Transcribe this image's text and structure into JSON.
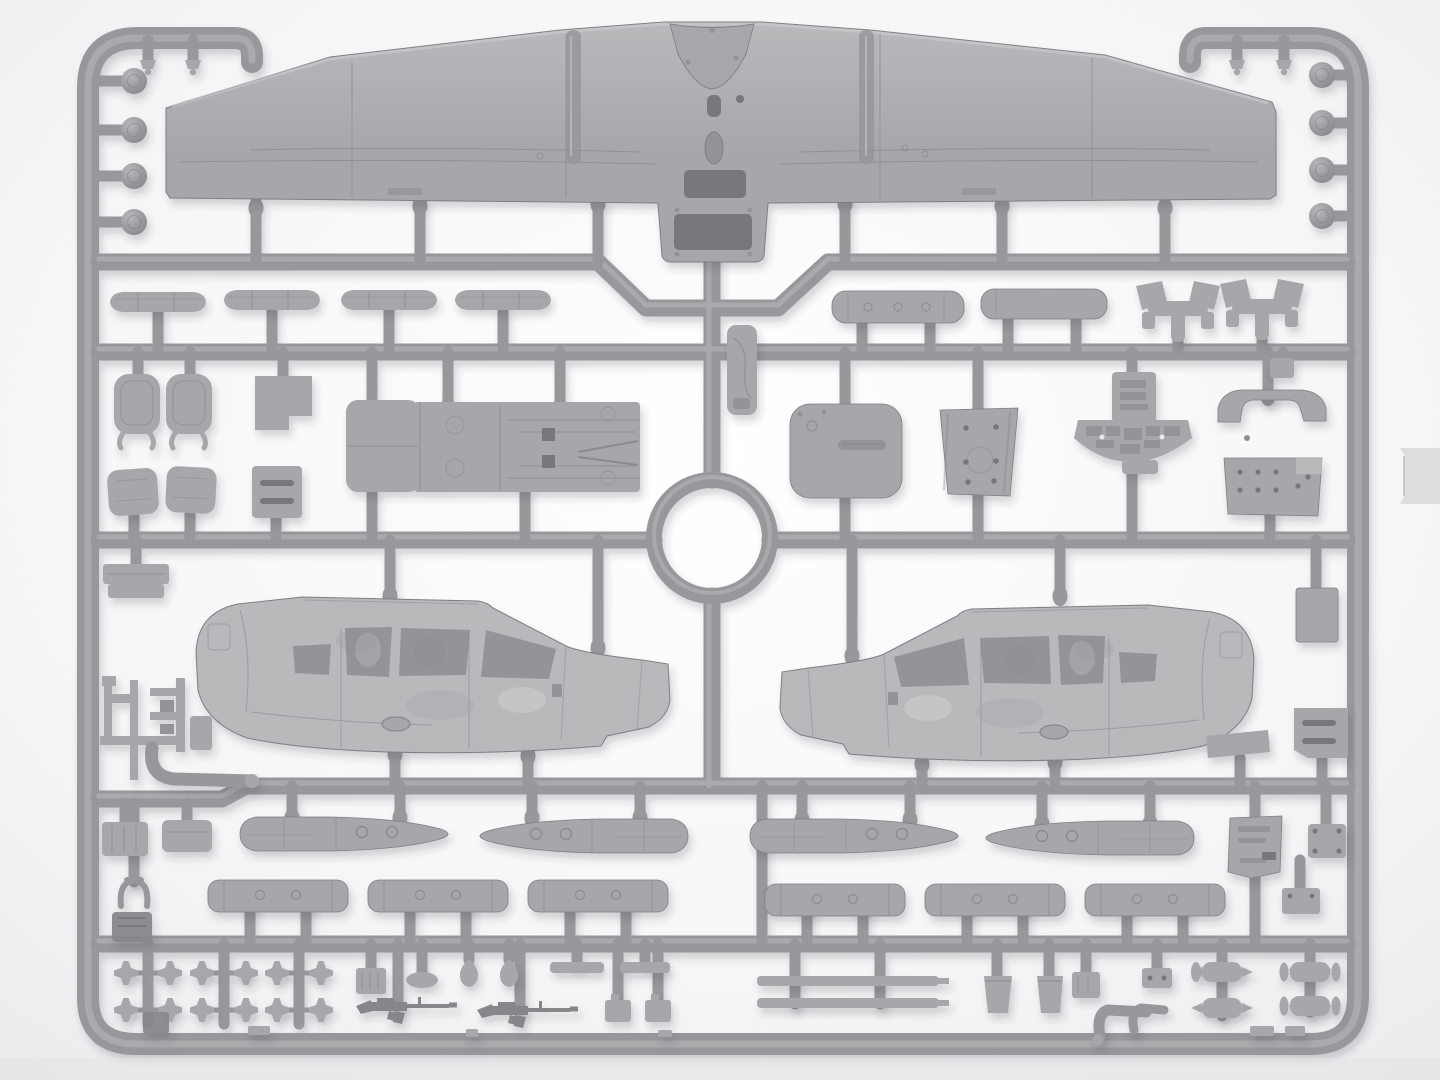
{
  "image_type": "photograph",
  "subject": {
    "description": "Gray injection-moulded plastic model-kit sprue of a twin-boom observation aircraft (one-piece wing, two fuselage pod halves, drop tanks, rocket pods, cockpit interior parts and small weapons) photographed on a white background",
    "orientation": "landscape",
    "material": "light-gray styrene plastic",
    "parts_visible": [
      {
        "name": "one-piece wing with cabin roof section",
        "count": 1
      },
      {
        "name": "fuselage pod half",
        "count": 2
      },
      {
        "name": "drop-tank half",
        "count": 4
      },
      {
        "name": "rocket-pod tube half",
        "count": 6
      },
      {
        "name": "slender pod / float blade",
        "count": 4
      },
      {
        "name": "engine cylinder drum",
        "count": 2
      },
      {
        "name": "engine mount bracket",
        "count": 2
      },
      {
        "name": "seat back",
        "count": 2
      },
      {
        "name": "seat cushion",
        "count": 2
      },
      {
        "name": "cabin floor",
        "count": 1
      },
      {
        "name": "cabin door panel",
        "count": 1
      },
      {
        "name": "riveted access panel",
        "count": 2
      },
      {
        "name": "instrument panel with radio console",
        "count": 1
      },
      {
        "name": "glareshield coaming",
        "count": 1
      },
      {
        "name": "slotted bulkhead panel",
        "count": 3
      },
      {
        "name": "engine-mount lattice frame",
        "count": 2
      },
      {
        "name": "exhaust elbow pipe",
        "count": 3
      },
      {
        "name": "M16 rifle",
        "count": 2
      },
      {
        "name": "cross-shaped control horn",
        "count": 12
      },
      {
        "name": "antenna strip",
        "count": 2
      },
      {
        "name": "small capsule fitting",
        "count": 4
      },
      {
        "name": "round mounting knob",
        "count": 8
      },
      {
        "name": "circular ring runner",
        "count": 1
      }
    ]
  },
  "palette": {
    "background": "#f6f6f7",
    "background_edge": "#eaeaec",
    "plastic": "#a7a7ab",
    "plastic_light": "#b9b9bc",
    "plastic_dark": "#86868b",
    "runner": "#98989c",
    "runner_highlight": "#b4b4b7",
    "recess": "#93939a",
    "hole": "#77777e",
    "panel_line": "#7e7e85",
    "shadow": "#3a3a44"
  },
  "lighting": {
    "type": "soft studio light",
    "shadow_direction": "lower-right",
    "shadow_opacity": 0.22
  }
}
